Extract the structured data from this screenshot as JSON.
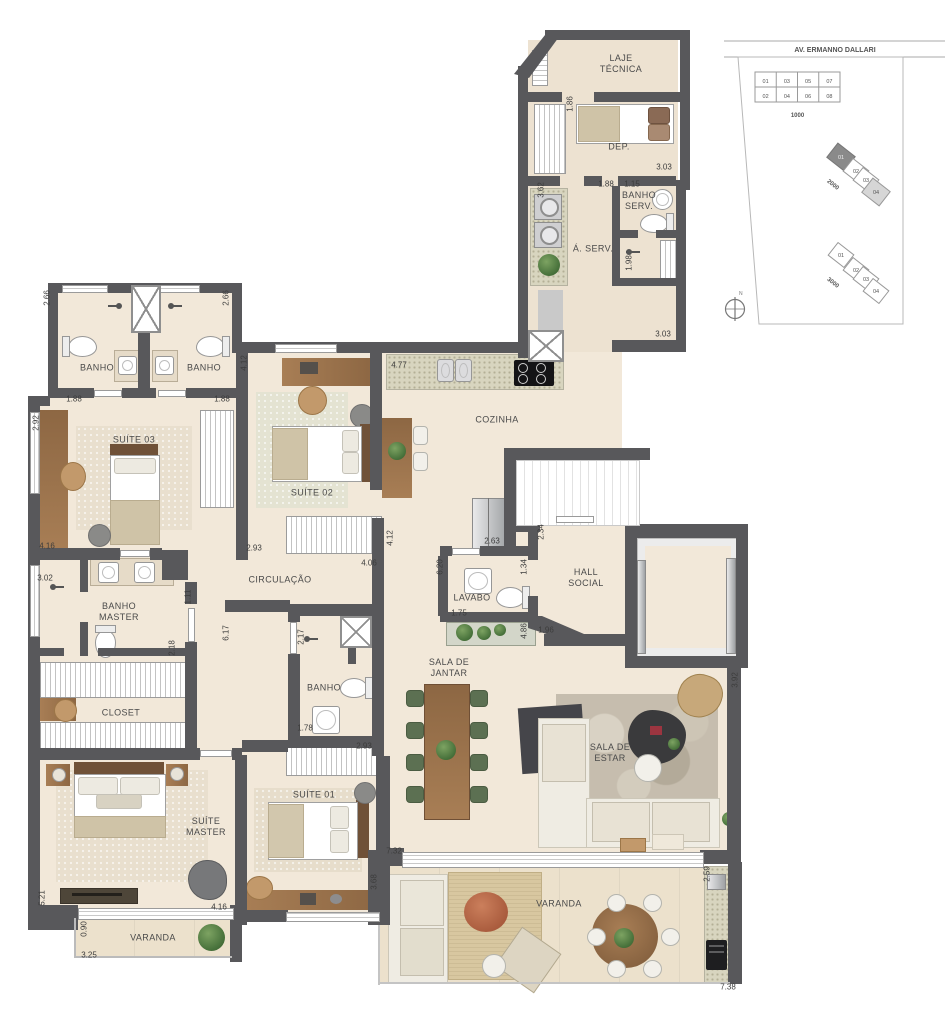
{
  "palette": {
    "wall": "#58585b",
    "floor": "#f2e8d9",
    "wood": "#a27953",
    "chair_green": "#5c7052",
    "terracotta": "#b96a4e"
  },
  "plan": {
    "rooms": {
      "laje_tecnica": "LAJE\nTÉCNICA",
      "dep": "DEP.",
      "banho_serv": "BANHO\nSERV.",
      "a_serv": "Á. SERV.",
      "cozinha": "COZINHA",
      "banho_1": "BANHO",
      "banho_2": "BANHO",
      "suite_03": "SUÍTE 03",
      "suite_02": "SUÍTE 02",
      "circulacao": "CIRCULAÇÃO",
      "lavabo": "LAVABO",
      "hall_social": "HALL\nSOCIAL",
      "banho_master": "BANHO\nMASTER",
      "closet": "CLOSET",
      "suite_master": "SUÍTE\nMASTER",
      "banho_s1": "BANHO",
      "suite_01": "SUÍTE 01",
      "sala_jantar": "SALA DE\nJANTAR",
      "sala_estar": "SALA DE\nESTAR",
      "varanda_small": "VARANDA",
      "varanda_big": "VARANDA"
    },
    "dimensions": [
      {
        "v": "1.86",
        "x": 570,
        "y": 104,
        "r": 1
      },
      {
        "v": "3.03",
        "x": 664,
        "y": 167
      },
      {
        "v": "1.88",
        "x": 606,
        "y": 184
      },
      {
        "v": "1.15",
        "x": 632,
        "y": 184
      },
      {
        "v": "3.62",
        "x": 541,
        "y": 190,
        "r": 1
      },
      {
        "v": "1.98",
        "x": 629,
        "y": 263,
        "r": 1
      },
      {
        "v": "3.03",
        "x": 663,
        "y": 334
      },
      {
        "v": "4.77",
        "x": 399,
        "y": 365
      },
      {
        "v": "2.63",
        "x": 492,
        "y": 541
      },
      {
        "v": "2.34",
        "x": 541,
        "y": 532,
        "r": 1
      },
      {
        "v": "2.66",
        "x": 47,
        "y": 298,
        "r": 1
      },
      {
        "v": "2.66",
        "x": 226,
        "y": 298,
        "r": 1
      },
      {
        "v": "1.88",
        "x": 74,
        "y": 399
      },
      {
        "v": "1.88",
        "x": 222,
        "y": 399
      },
      {
        "v": "4.12",
        "x": 244,
        "y": 363,
        "r": 1
      },
      {
        "v": "2.92",
        "x": 36,
        "y": 423,
        "r": 1
      },
      {
        "v": "4.16",
        "x": 47,
        "y": 546
      },
      {
        "v": "3.02",
        "x": 45,
        "y": 578
      },
      {
        "v": "2.93",
        "x": 254,
        "y": 548
      },
      {
        "v": "4.06",
        "x": 369,
        "y": 563
      },
      {
        "v": "4.12",
        "x": 390,
        "y": 538,
        "r": 1
      },
      {
        "v": "6.20",
        "x": 440,
        "y": 567,
        "r": 1
      },
      {
        "v": "1.34",
        "x": 524,
        "y": 567,
        "r": 1
      },
      {
        "v": "1.75",
        "x": 459,
        "y": 613
      },
      {
        "v": "4.86",
        "x": 524,
        "y": 631,
        "r": 1
      },
      {
        "v": "1.96",
        "x": 546,
        "y": 630
      },
      {
        "v": "1.11",
        "x": 188,
        "y": 597,
        "r": 1
      },
      {
        "v": "6.17",
        "x": 226,
        "y": 633,
        "r": 1
      },
      {
        "v": "2.18",
        "x": 172,
        "y": 648,
        "r": 1
      },
      {
        "v": "2.17",
        "x": 301,
        "y": 637,
        "r": 1
      },
      {
        "v": "1.78",
        "x": 305,
        "y": 728
      },
      {
        "v": "2.93",
        "x": 364,
        "y": 746
      },
      {
        "v": "7.32",
        "x": 394,
        "y": 851
      },
      {
        "v": "3.68",
        "x": 374,
        "y": 882,
        "r": 1
      },
      {
        "v": "3.92",
        "x": 735,
        "y": 680,
        "r": 1
      },
      {
        "v": "5.21",
        "x": 42,
        "y": 898,
        "r": 1
      },
      {
        "v": "4.16",
        "x": 219,
        "y": 907
      },
      {
        "v": "0.90",
        "x": 84,
        "y": 929,
        "r": 1
      },
      {
        "v": "3.25",
        "x": 89,
        "y": 955
      },
      {
        "v": "2.59",
        "x": 707,
        "y": 874,
        "r": 1
      },
      {
        "v": "7.38",
        "x": 728,
        "y": 987
      }
    ]
  },
  "site_plan": {
    "street": "AV. ERMANNO DALLARI",
    "tower_1000": {
      "label": "1000",
      "row1": [
        "01",
        "03",
        "05",
        "07"
      ],
      "row2": [
        "02",
        "04",
        "06",
        "08"
      ]
    },
    "tower_2000": {
      "label": "2000",
      "units": [
        "01",
        "02",
        "03",
        "04"
      ],
      "highlighted_unit": "01"
    },
    "tower_3000": {
      "label": "3000",
      "units": [
        "01",
        "02",
        "03",
        "04"
      ]
    },
    "north_label": "N"
  }
}
